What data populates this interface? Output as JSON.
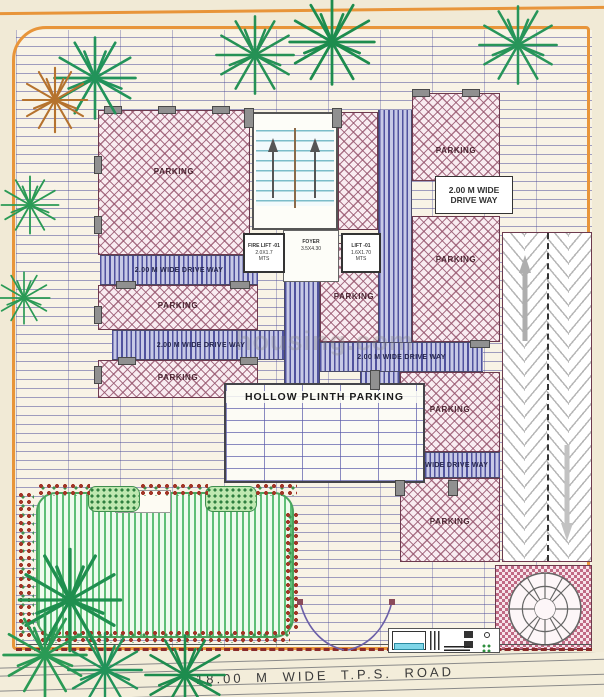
{
  "labels": {
    "parking": "PARKING",
    "driveway": "2.00 M WIDE DRIVE WAY",
    "driveway_line1": "2.00 M WIDE",
    "driveway_line2": "DRIVE WAY",
    "hollow_plinth": "HOLLOW PLINTH  PARKING",
    "road": "18.00  M  WIDE  T.P.S.  ROAD",
    "foyer_name": "FOYER",
    "foyer_size": "3.5X4.30",
    "fire_lift_name": "FIRE LIFT -01",
    "fire_lift_size": "2.0X1.7",
    "fire_lift_unit": "MTS",
    "lift_name": "LIFT -01",
    "lift_size": "1.6X1.70",
    "lift_unit": "MTS",
    "watermark": "housing.com"
  },
  "colors": {
    "boundary_orange": "#e8953a",
    "parking_hatch": "#96556e",
    "driveway_stripe": "#50529e",
    "grid_line": "#4646a0",
    "lawn_green": "#5fbf77",
    "wall_maroon": "#6d3a4e",
    "checker_pink": "#c06a84",
    "road_dash_red": "#8a2a2a"
  }
}
